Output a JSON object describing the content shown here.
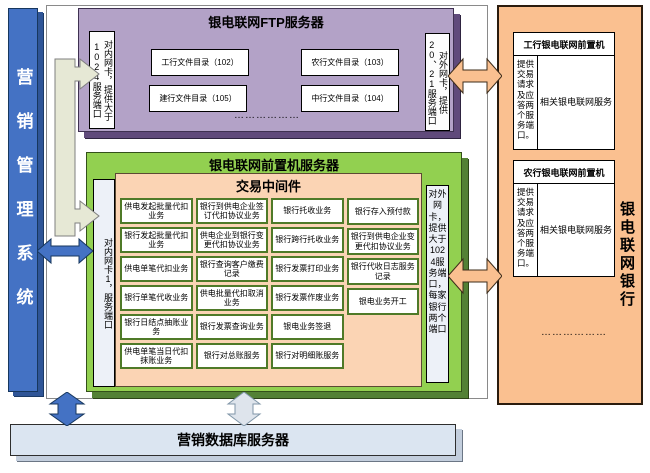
{
  "left_bar": {
    "title": "营销管理系统"
  },
  "ftp_server": {
    "title": "银电联网FTP服务器",
    "left_label": "对内网卡，提供大于1024服务端口",
    "right_label": "对外网卡，提供20、21服务端口",
    "directories": [
      "工行文件目录（102）",
      "农行文件目录（103）",
      "建行文件目录（105）",
      "中行文件目录（104）"
    ],
    "ellipsis": "………………"
  },
  "frontend_server": {
    "title": "银电联网前置机服务器",
    "left_label": "对内网卡1，服务端口",
    "right_label": "对外网卡，提供大于1024服务端口，每家银行两个端口",
    "middleware": {
      "title": "交易中间件",
      "col1": [
        "供电发起批量代扣业务",
        "银行发起批量代扣业务",
        "供电单笔代扣业务",
        "银行单笔代收业务",
        "银行日结点抽账业务",
        "供电单笔当日代扣抹账业务"
      ],
      "col2": [
        "银行到供电企业签订代扣协议业务",
        "供电企业到银行变更代扣协议业务",
        "银行查询客户缴费记录",
        "供电批量代扣取消业务",
        "银行发票查询业务",
        "银行对总账服务"
      ],
      "col3": [
        "银行托收业务",
        "银行跨行托收业务",
        "银行发票打印业务",
        "银行发票作废业务",
        "银电业务签退",
        "银行对明细账服务"
      ],
      "col4": [
        "银行存入预付款",
        "银行到供电企业变更代扣协议业务",
        "银行代收日志服务记录",
        "银电业务开工"
      ]
    }
  },
  "bank_panel": {
    "title": "银电联网银行",
    "banks": [
      {
        "header": "工行银电联网前置机",
        "side": "提供交易请求及应答两个服务端口。",
        "body": "相关银电联网服务"
      },
      {
        "header": "农行银电联网前置机",
        "side": "提供交易请求及应答两个服务端口。",
        "body": "相关银电联网服务"
      }
    ],
    "ellipsis": "………………"
  },
  "db_server": {
    "title": "营销数据库服务器"
  },
  "colors": {
    "blue_bar": "#4472C4",
    "purple_box": "#B3A2C7",
    "green_box": "#92D050",
    "middleware_box": "#FBD4B4",
    "bank_panel": "#FAC090",
    "db_bar": "#DBE5F1",
    "cell_border": "#4F7A28",
    "connector_beige": "#E6E8D5"
  }
}
